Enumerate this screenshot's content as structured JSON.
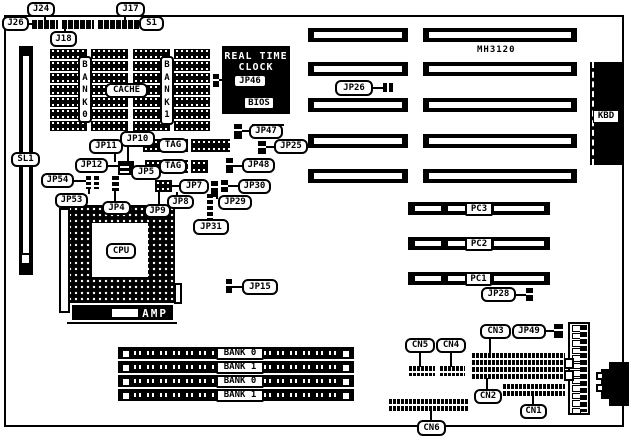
{
  "board": {
    "model": "MH3120",
    "colors": {
      "foreground": "#000000",
      "background": "#ffffff"
    },
    "labels": {
      "j24": "J24",
      "j17": "J17",
      "j26": "J26",
      "s1": "S1",
      "j18": "J18",
      "sl1": "SL1",
      "cache": "CACHE",
      "bank0": "BANK0",
      "bank1": "BANK1",
      "tag1": "TAG",
      "tag2": "TAG",
      "jp4": "JP4",
      "jp5": "JP5",
      "jp7": "JP7",
      "jp8": "JP8",
      "jp9": "JP9",
      "jp10": "JP10",
      "jp11": "JP11",
      "jp12": "JP12",
      "jp15": "JP15",
      "jp25": "JP25",
      "jp26": "JP26",
      "jp28": "JP28",
      "jp29": "JP29",
      "jp30": "JP30",
      "jp31": "JP31",
      "jp46": "JP46",
      "jp47": "JP47",
      "jp48": "JP48",
      "jp49": "JP49",
      "jp53": "JP53",
      "jp54": "JP54",
      "cpu": "CPU",
      "amp": "AMP",
      "bios": "BIOS",
      "kbd": "KBD",
      "rtc_line1": "REAL TIME",
      "rtc_line2": "CLOCK",
      "pc1": "PC1",
      "pc2": "PC2",
      "pc3": "PC3",
      "cn1": "CN1",
      "cn2": "CN2",
      "cn3": "CN3",
      "cn4": "CN4",
      "cn5": "CN5",
      "cn6": "CN6"
    },
    "memory_banks": [
      "BANK 0",
      "BANK 1",
      "BANK 0",
      "BANK 1"
    ]
  }
}
